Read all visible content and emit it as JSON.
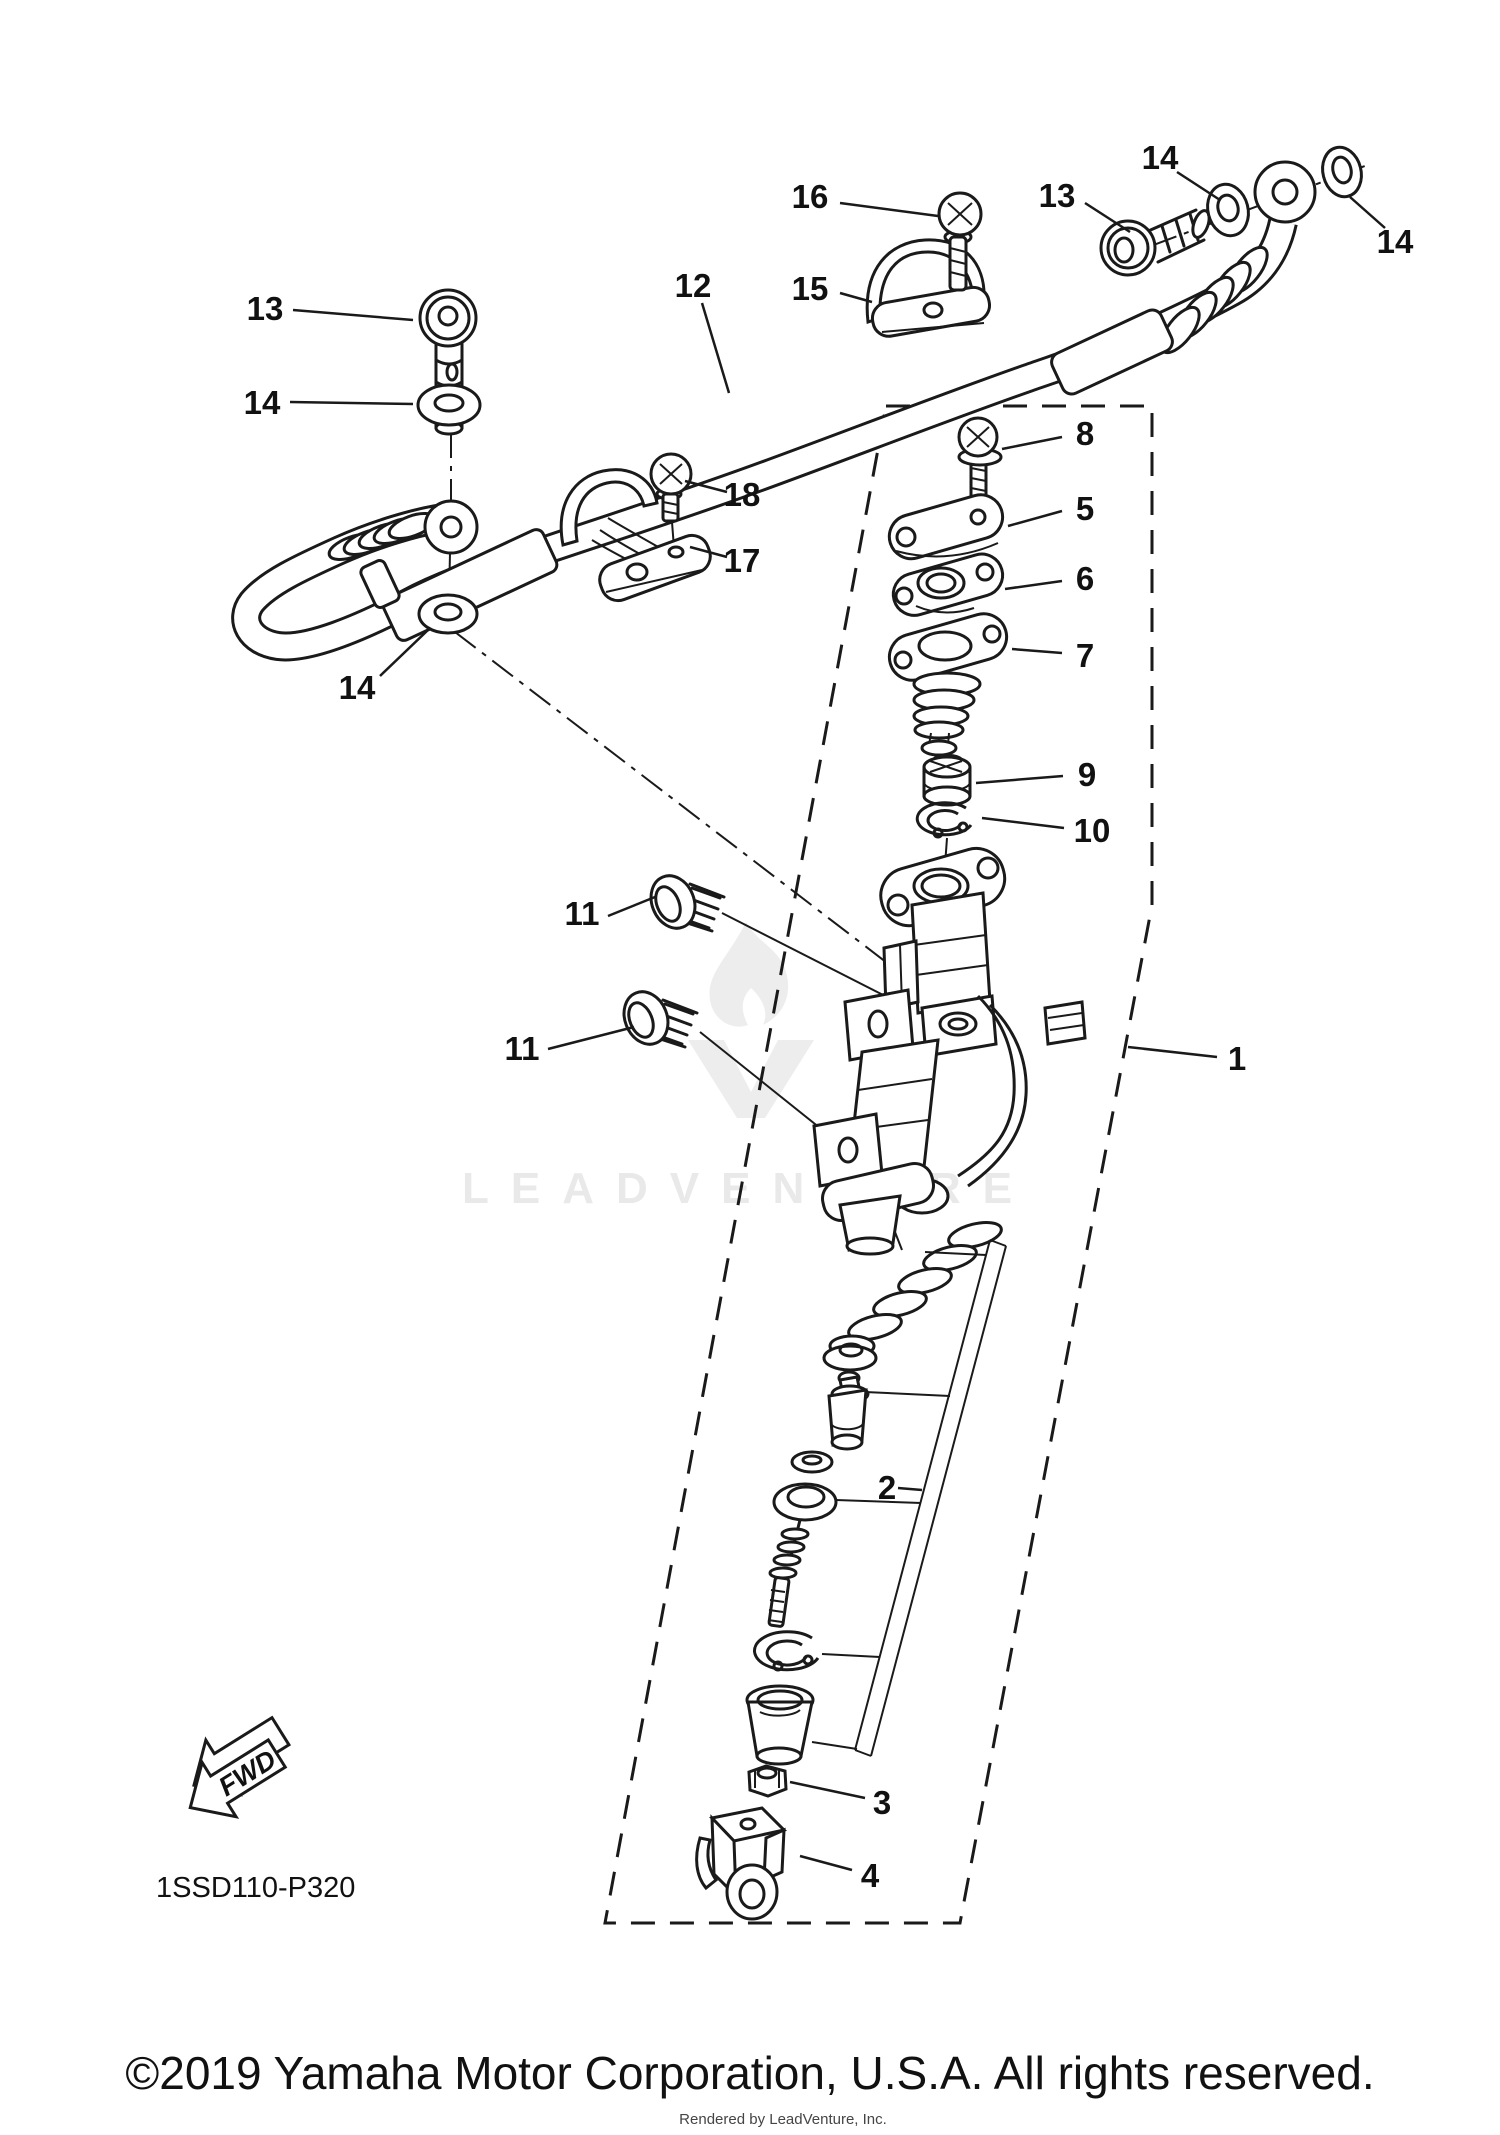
{
  "meta": {
    "diagram_code": "1SSD110-P320",
    "fwd_label": "FWD",
    "watermark": "LEADVENTURE",
    "copyright": "©2019 Yamaha Motor Corporation, U.S.A. All rights reserved.",
    "rendered_by": "Rendered by LeadVenture, Inc.",
    "colors": {
      "line": "#1a1a1a",
      "background": "#ffffff",
      "watermark": "#ededed"
    }
  },
  "diagram": {
    "type": "exploded-parts-diagram",
    "subject": "rear master cylinder assembly with brake hose",
    "callouts": [
      {
        "label": "16",
        "x": 810,
        "y": 196,
        "lx1": 840,
        "ly1": 203,
        "lx2": 938,
        "ly2": 216
      },
      {
        "label": "13",
        "x": 1057,
        "y": 195,
        "lx1": 1085,
        "ly1": 203,
        "lx2": 1130,
        "ly2": 232
      },
      {
        "label": "14",
        "x": 1160,
        "y": 157,
        "lx1": 1177,
        "ly1": 172,
        "lx2": 1220,
        "ly2": 200
      },
      {
        "label": "14",
        "x": 1395,
        "y": 241,
        "lx1": 1385,
        "ly1": 228,
        "lx2": 1350,
        "ly2": 197
      },
      {
        "label": "15",
        "x": 810,
        "y": 288,
        "lx1": 840,
        "ly1": 293,
        "lx2": 872,
        "ly2": 302
      },
      {
        "label": "12",
        "x": 693,
        "y": 285,
        "lx1": 702,
        "ly1": 303,
        "lx2": 729,
        "ly2": 393
      },
      {
        "label": "13",
        "x": 265,
        "y": 308,
        "lx1": 293,
        "ly1": 310,
        "lx2": 413,
        "ly2": 320
      },
      {
        "label": "14",
        "x": 262,
        "y": 402,
        "lx1": 290,
        "ly1": 402,
        "lx2": 413,
        "ly2": 404
      },
      {
        "label": "14",
        "x": 357,
        "y": 687,
        "lx1": 380,
        "ly1": 676,
        "lx2": 428,
        "ly2": 630
      },
      {
        "label": "18",
        "x": 742,
        "y": 494,
        "lx1": 727,
        "ly1": 492,
        "lx2": 685,
        "ly2": 481
      },
      {
        "label": "17",
        "x": 742,
        "y": 560,
        "lx1": 727,
        "ly1": 557,
        "lx2": 690,
        "ly2": 547
      },
      {
        "label": "8",
        "x": 1085,
        "y": 433,
        "lx1": 1062,
        "ly1": 437,
        "lx2": 1002,
        "ly2": 449
      },
      {
        "label": "5",
        "x": 1085,
        "y": 508,
        "lx1": 1062,
        "ly1": 511,
        "lx2": 1008,
        "ly2": 526
      },
      {
        "label": "6",
        "x": 1085,
        "y": 578,
        "lx1": 1062,
        "ly1": 581,
        "lx2": 1005,
        "ly2": 589
      },
      {
        "label": "7",
        "x": 1085,
        "y": 655,
        "lx1": 1062,
        "ly1": 653,
        "lx2": 1012,
        "ly2": 649
      },
      {
        "label": "9",
        "x": 1087,
        "y": 774,
        "lx1": 1063,
        "ly1": 776,
        "lx2": 976,
        "ly2": 783
      },
      {
        "label": "10",
        "x": 1092,
        "y": 830,
        "lx1": 1064,
        "ly1": 828,
        "lx2": 982,
        "ly2": 818
      },
      {
        "label": "11",
        "x": 582,
        "y": 913,
        "lx1": 608,
        "ly1": 916,
        "lx2": 655,
        "ly2": 897
      },
      {
        "label": "11",
        "x": 522,
        "y": 1048,
        "lx1": 548,
        "ly1": 1049,
        "lx2": 634,
        "ly2": 1027
      },
      {
        "label": "1",
        "x": 1237,
        "y": 1058,
        "lx1": 1217,
        "ly1": 1057,
        "lx2": 1128,
        "ly2": 1047
      },
      {
        "label": "2",
        "x": 887,
        "y": 1487,
        "lx1": 898,
        "ly1": 1488,
        "lx2": 922,
        "ly2": 1490
      },
      {
        "label": "3",
        "x": 882,
        "y": 1802,
        "lx1": 865,
        "ly1": 1798,
        "lx2": 790,
        "ly2": 1782
      },
      {
        "label": "4",
        "x": 870,
        "y": 1875,
        "lx1": 852,
        "ly1": 1870,
        "lx2": 800,
        "ly2": 1856
      }
    ]
  }
}
